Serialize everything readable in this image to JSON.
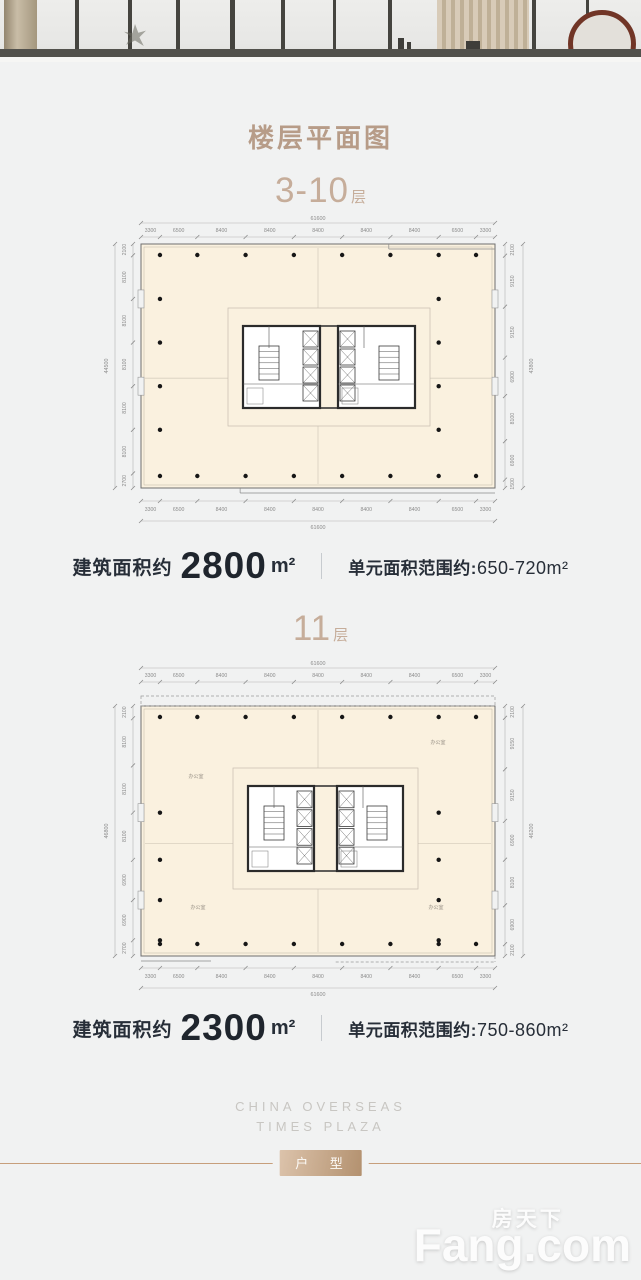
{
  "title": "楼层平面图",
  "colors": {
    "accent_tan": "#b79c88",
    "floor_label_tan": "#c6ad9a",
    "plate_fill": "#faf1df",
    "badge_gradient_from": "#dcc3ab",
    "badge_gradient_to": "#b3916f",
    "rule_line": "#c79f7c",
    "text_dark": "#272e38"
  },
  "sections": [
    {
      "floors": "3-10",
      "floor_suffix": "层",
      "area_label": "建筑面积约",
      "area_value": "2800",
      "area_unit": "m²",
      "range_label": "单元面积范围约:",
      "range_value": "650-720m²",
      "plan": {
        "overall_h": "61600",
        "dims_h": [
          "3300",
          "6500",
          "8400",
          "8400",
          "8400",
          "8400",
          "8400",
          "6500",
          "3300"
        ],
        "overall_left": "44500",
        "dims_left": [
          "2100",
          "8100",
          "8100",
          "8100",
          "8100",
          "8100",
          "2700"
        ],
        "overall_right": "43800",
        "dims_right": [
          "2100",
          "9150",
          "9150",
          "6900",
          "8100",
          "6900",
          "1500"
        ],
        "room_labels": []
      }
    },
    {
      "floors": "11",
      "floor_suffix": "层",
      "area_label": "建筑面积约",
      "area_value": "2300",
      "area_unit": "m²",
      "range_label": "单元面积范围约:",
      "range_value": "750-860m²",
      "plan": {
        "overall_h": "61600",
        "dims_h": [
          "3300",
          "6500",
          "8400",
          "8400",
          "8400",
          "8400",
          "8400",
          "6500",
          "3300"
        ],
        "overall_left": "46800",
        "dims_left": [
          "2100",
          "8100",
          "8100",
          "8100",
          "6900",
          "6900",
          "2700"
        ],
        "overall_right": "46200",
        "dims_right": [
          "2100",
          "9150",
          "9150",
          "6900",
          "8100",
          "6900",
          "2100"
        ],
        "room_labels": [
          "办公室",
          "办公室",
          "办公室",
          "办公室"
        ]
      }
    }
  ],
  "footer": {
    "brand_line1": "CHINA OVERSEAS",
    "brand_line2": "TIMES PLAZA",
    "badge": "户 型"
  },
  "watermark": {
    "cn": "房天下",
    "en": "Fang.com"
  }
}
